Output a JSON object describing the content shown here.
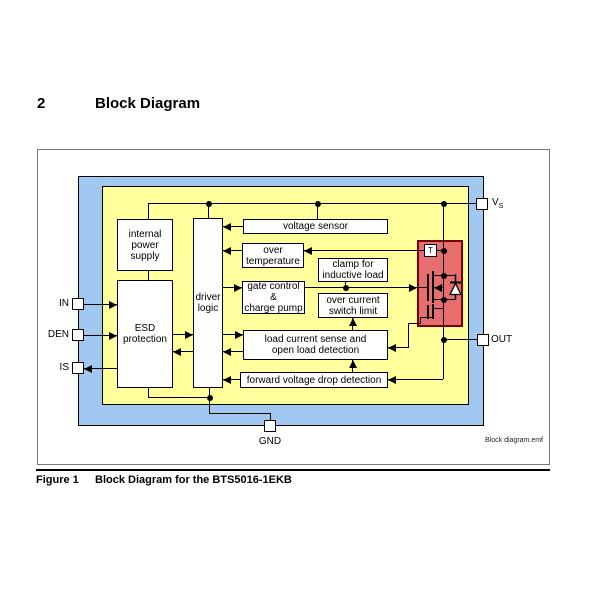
{
  "page": {
    "section_number": "2",
    "section_title": "Block Diagram",
    "caption_label": "Figure 1",
    "caption_title": "Block Diagram for the BTS5016-1EKB",
    "watermark": "Block diagram.emf"
  },
  "diagram": {
    "colors": {
      "chip_outer": "#A0C8F0",
      "chip_inner": "#FFFF9B",
      "power_stage_fill": "#E66E6E",
      "power_stage_border": "#7a0000"
    },
    "blocks": {
      "internal_power_supply": "internal\npower\nsupply",
      "esd_protection": "ESD\nprotection",
      "driver_logic": "driver\nlogic",
      "voltage_sensor": "voltage sensor",
      "over_temperature": "over\ntemperature",
      "clamp_inductive_load": "clamp for\ninductive load",
      "gate_control_charge_pump": "gate control\n&\ncharge pump",
      "over_current_switch_limit": "over current\nswitch limit",
      "load_current_sense": "load current sense and\nopen load detection",
      "forward_voltage_drop": "forward voltage drop detection",
      "temp_sensor": "T"
    },
    "pins": {
      "vs_main": "V",
      "vs_sub": "S",
      "in": "IN",
      "den": "DEN",
      "is": "IS",
      "out": "OUT",
      "gnd": "GND"
    }
  }
}
